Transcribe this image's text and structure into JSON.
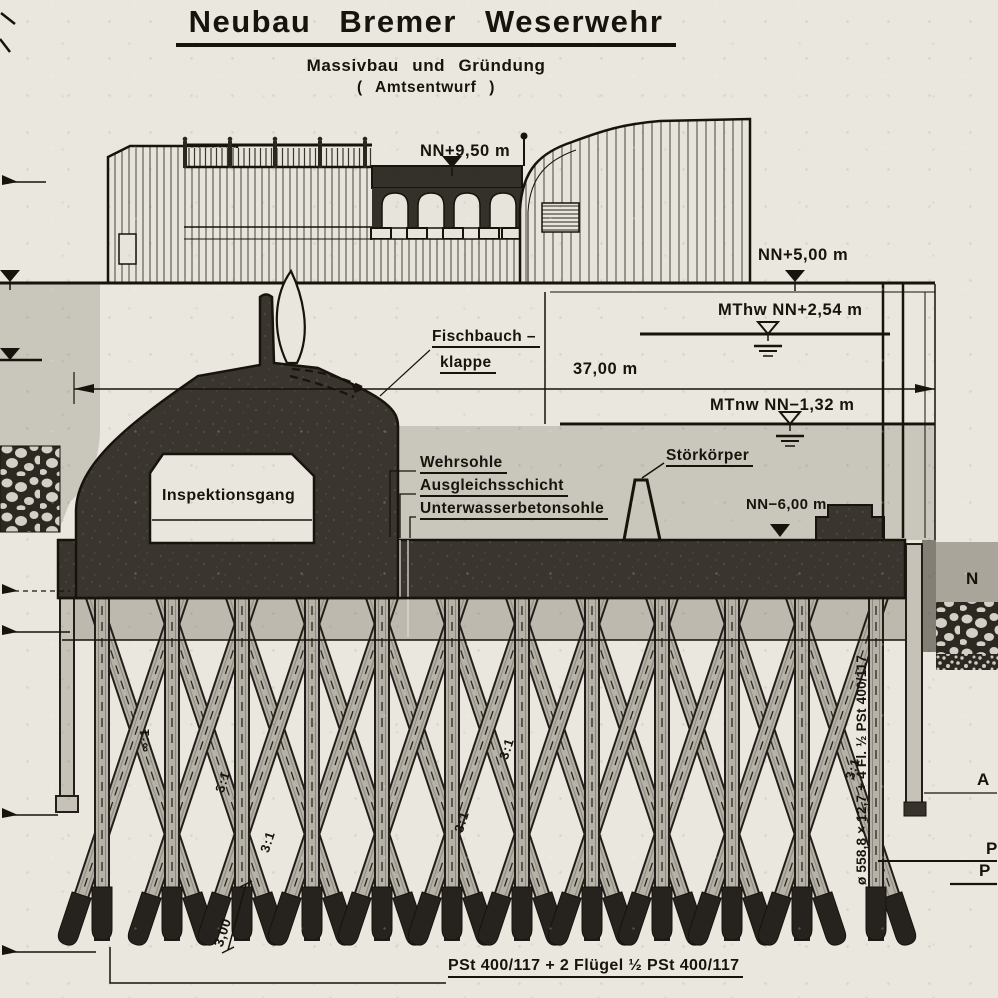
{
  "title": {
    "main": "Neubau Bremer Weserwehr",
    "sub1": "Massivbau und Gründung",
    "sub2": "( Amtsentwurf )"
  },
  "levels": {
    "deck": "NN+9,50 m",
    "top": "NN+5,00 m",
    "mthw": "MThw NN+2,54 m",
    "mtnw": "MTnw NN−1,32 m",
    "sill": "NN−6,00 m"
  },
  "dimensions": {
    "weir_width": "37,00 m",
    "pile_tip_length": "3,00"
  },
  "labels": {
    "flap_line1": "Fischbauch –",
    "flap_line2": "klappe",
    "gallery": "Inspektionsgang",
    "weir_sill": "Wehrsohle",
    "leveling_layer": "Ausgleichsschicht",
    "underwater_concrete": "Unterwasserbetonsohle",
    "baffle": "Störkörper"
  },
  "piles": {
    "tube_pile_note": "ø 558,8 × 12,7 + 4 Fl. ½ PSt 400/117",
    "sheet_pile_note": "PSt 400/117 + 2 Flügel ½ PSt 400/117"
  },
  "slopes": [
    "∞:1",
    "3:1",
    "3:1",
    "3:1",
    "3:1",
    "3:1"
  ],
  "edge": {
    "n": "N",
    "a": "A",
    "p1": "P",
    "p2": "P"
  },
  "colors": {
    "paper": "#eae7df",
    "water_tone": "#c9c6bc",
    "concrete": "#3a362f",
    "pile": "#b6b2a7",
    "ink": "#17130d"
  }
}
